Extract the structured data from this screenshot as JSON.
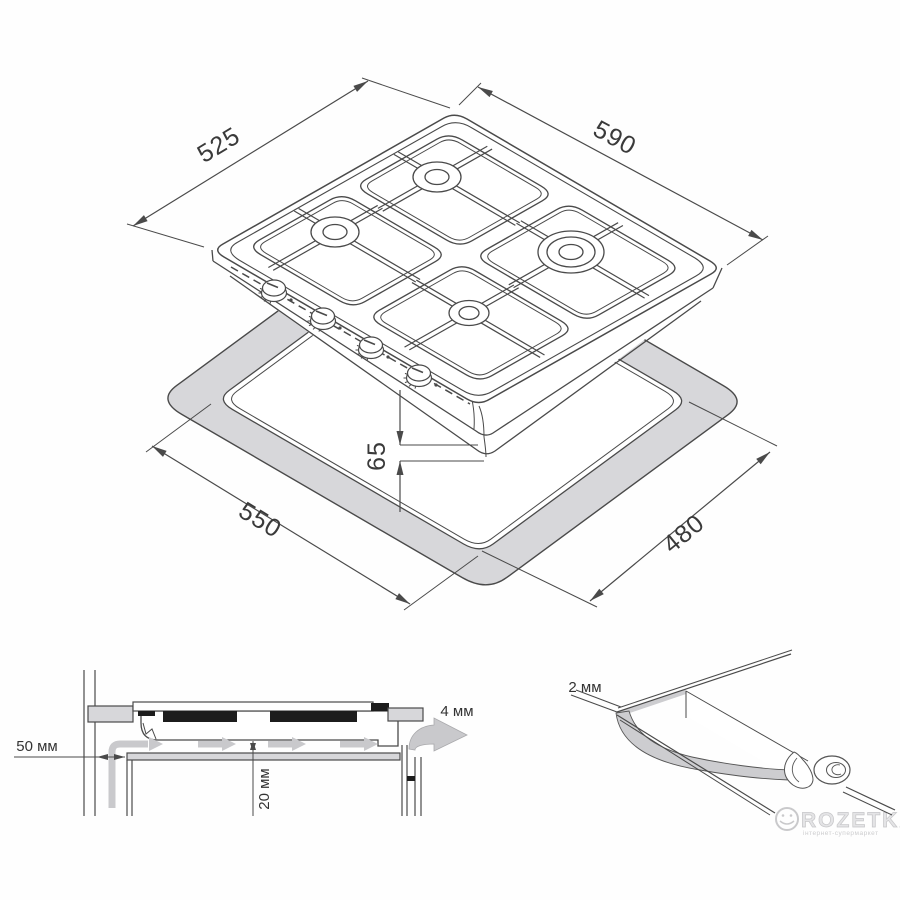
{
  "figure": {
    "type": "technical-installation-drawing",
    "subject": "4-burner gas hob installation diagram",
    "colors": {
      "line": "#4a4a4a",
      "thin_line": "#5a5a5a",
      "text": "#3a3a3a",
      "countertop_fill": "#d7d7da",
      "seal_fill": "#cdcdd0",
      "airflow": "#c9c9cc",
      "black_part": "#1c1c1c",
      "watermark": "#c9c9cb"
    },
    "dimensions": {
      "hob_depth": "525",
      "hob_width": "590",
      "cutout_width": "550",
      "cutout_depth": "480",
      "hob_height": "65",
      "rear_clearance": "50 мм",
      "vent_gap": "4 мм",
      "under_clearance": "20 мм",
      "seal_thickness": "2 мм"
    },
    "watermark": {
      "brand": "ROZETKA",
      "tagline": "інтернет-супермаркет"
    }
  }
}
